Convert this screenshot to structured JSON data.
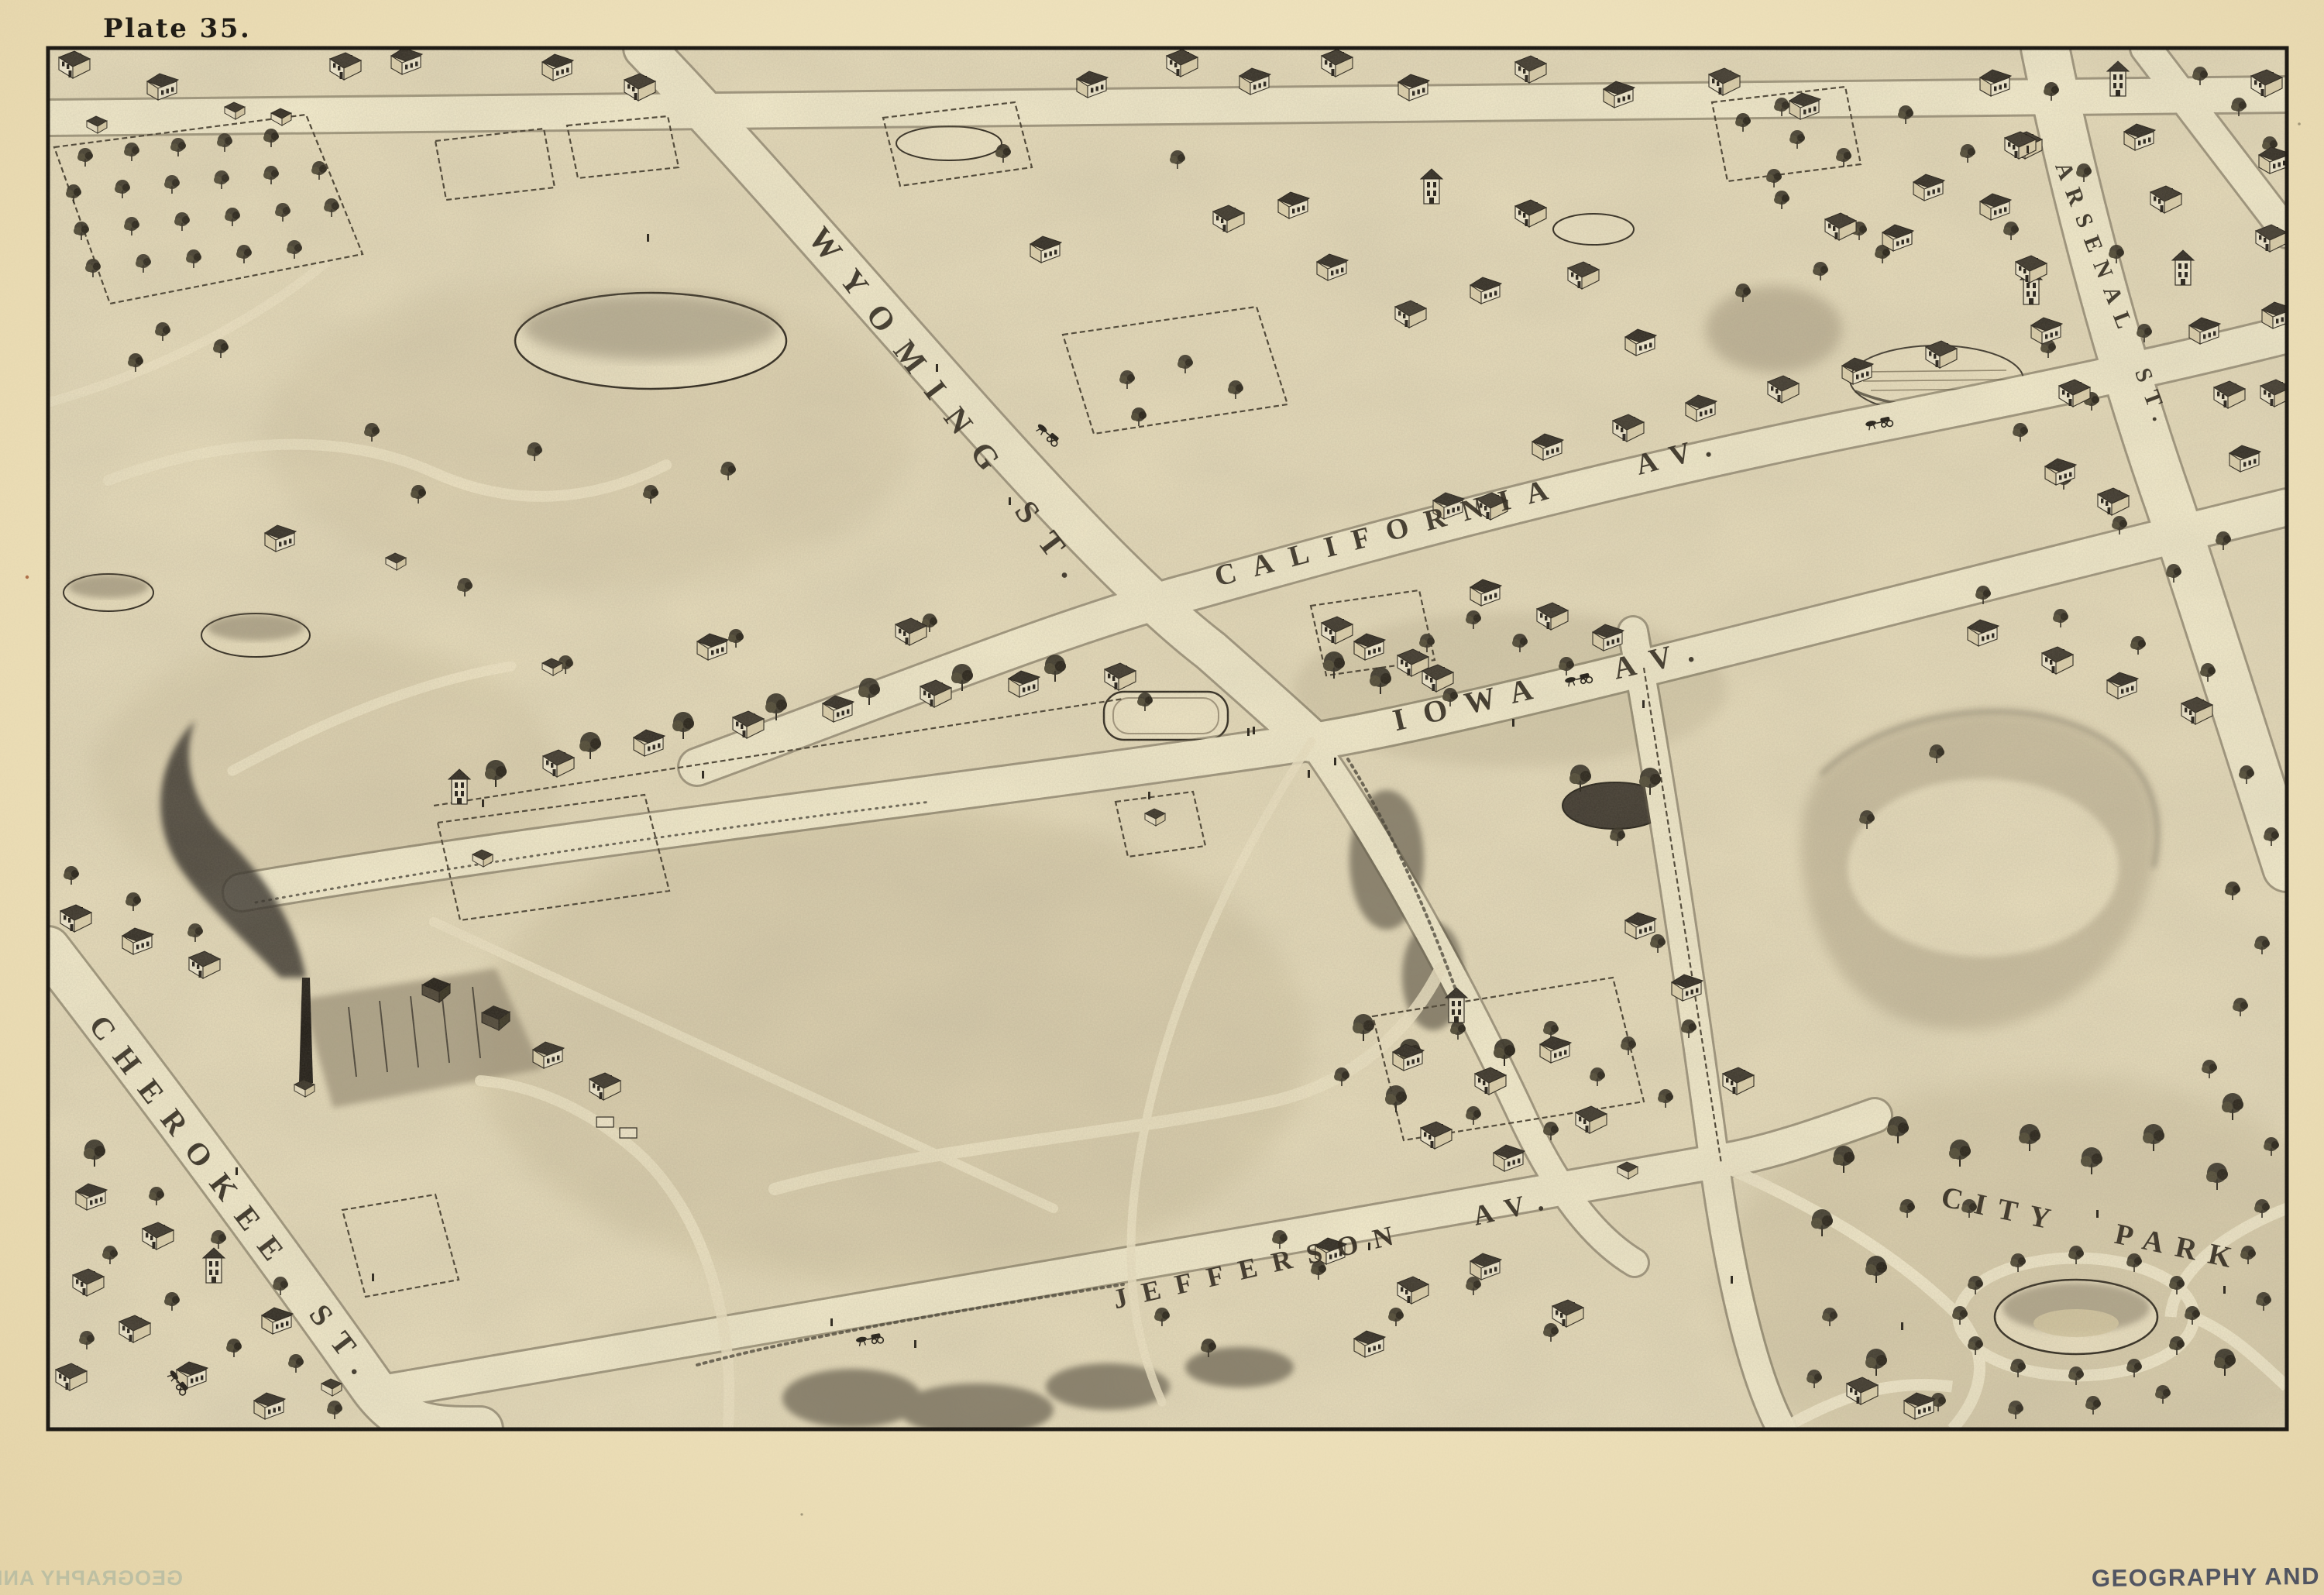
{
  "labels": {
    "plate": "Plate 35.",
    "streets": {
      "wyoming": "WYOMING ST.",
      "california": "CALIFORNIA AV.",
      "iowa": "IOWA AV.",
      "jefferson": "JEFFERSON AV.",
      "cherokee": "CHEROKEE ST.",
      "arsenal": "ARSENAL ST."
    },
    "park": "CITY PARK",
    "stamp": "GEOGRAPHY AND MAP DIVISION"
  },
  "colors": {
    "paper": "#f1e5c2",
    "map_field": "#e9debd",
    "road": "#f6eecf",
    "ink": "#201b13",
    "stamp_ink": "#3c4257",
    "offset_stamp_ink": "#9eb0a0"
  }
}
